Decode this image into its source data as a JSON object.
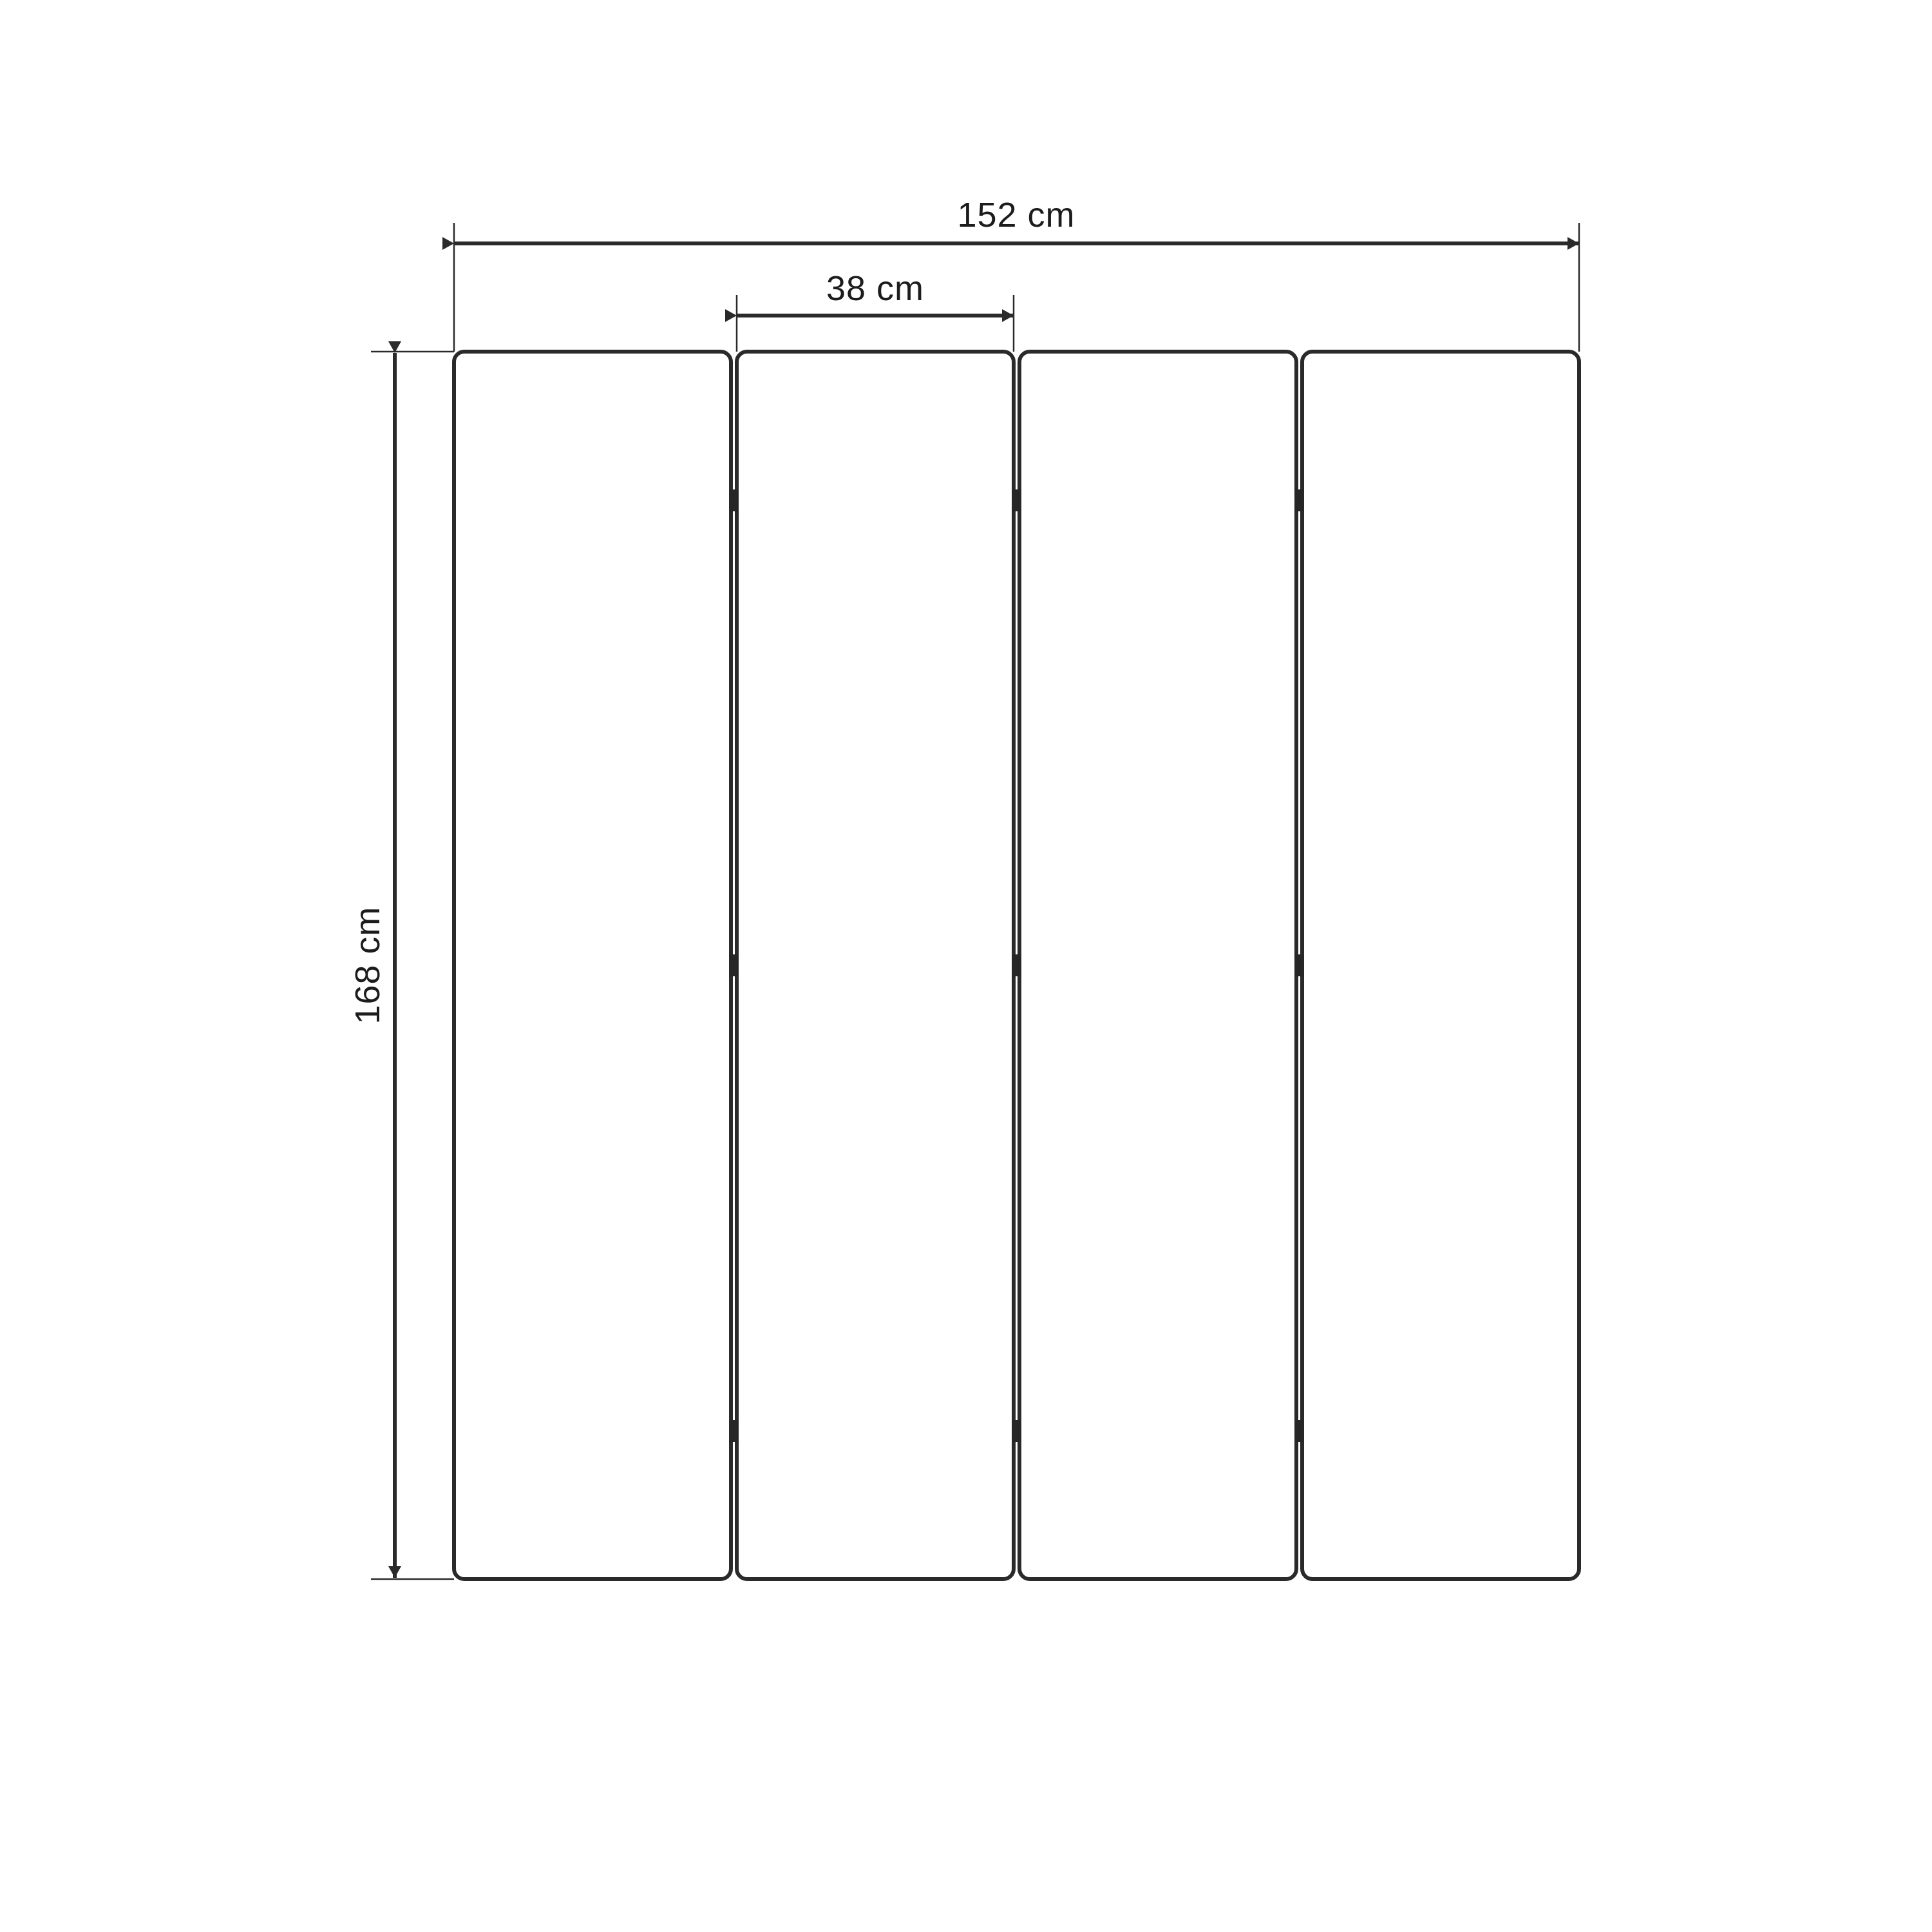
{
  "diagram": {
    "background_color": "#ffffff",
    "line_color": "#2a2a2a",
    "text_color": "#1c1c1c",
    "panel_count": 4,
    "hinge_rows": 3,
    "dimensions": {
      "total_width": {
        "label": "152 cm",
        "value": 152,
        "unit": "cm"
      },
      "panel_width": {
        "label": "38 cm",
        "value": 38,
        "unit": "cm"
      },
      "panel_height": {
        "label": "168 cm",
        "value": 168,
        "unit": "cm"
      }
    }
  }
}
